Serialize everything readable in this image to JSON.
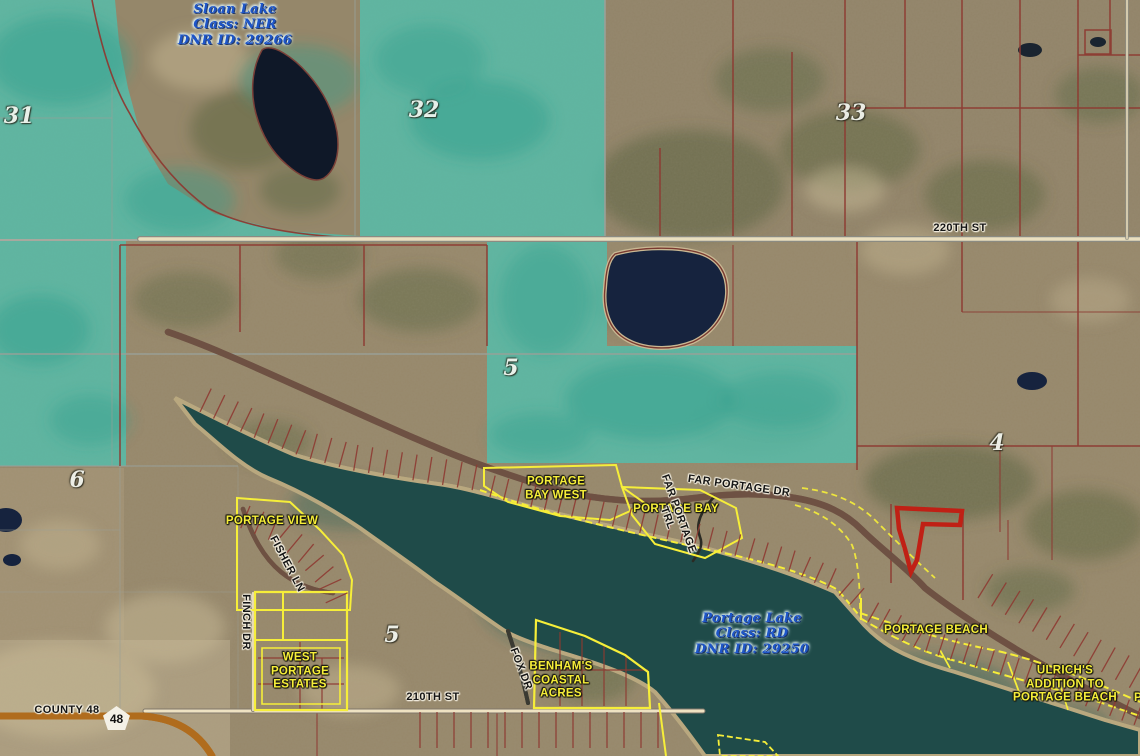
{
  "map": {
    "colors": {
      "teal_overlay": "#52bfae",
      "water_dark": "#1c2b44",
      "lake_green": "#1f4b49",
      "parcel_line": "#8e3a32",
      "selected_parcel": "#c02015",
      "subdivision_yellow": "#f6ee39",
      "road_fill": "#eee2c2",
      "county_road_orange": "#f0a43c",
      "lake_label_blue": "#1d55c9"
    },
    "lake_labels": [
      {
        "lines": [
          "Sloan Lake",
          "Class: NER",
          "DNR ID: 29266"
        ],
        "x": 235,
        "y": 25,
        "rot": 0
      },
      {
        "lines": [
          "Portage Lake",
          "Class: RD",
          "DNR ID: 29250"
        ],
        "x": 752,
        "y": 634,
        "rot": 0
      }
    ],
    "section_numbers": [
      {
        "lines": [
          "31"
        ],
        "x": 19,
        "y": 116,
        "rot": 0
      },
      {
        "lines": [
          "32"
        ],
        "x": 424,
        "y": 110,
        "rot": 0
      },
      {
        "lines": [
          "33"
        ],
        "x": 851,
        "y": 113,
        "rot": 0
      },
      {
        "lines": [
          "5"
        ],
        "x": 511,
        "y": 368,
        "rot": 0
      },
      {
        "lines": [
          "6"
        ],
        "x": 77,
        "y": 480,
        "rot": 0
      },
      {
        "lines": [
          "4"
        ],
        "x": 997,
        "y": 443,
        "rot": 0
      },
      {
        "lines": [
          "5"
        ],
        "x": 392,
        "y": 635,
        "rot": 0
      }
    ],
    "road_labels": [
      {
        "lines": [
          "220TH ST"
        ],
        "x": 960,
        "y": 228,
        "rot": 0
      },
      {
        "lines": [
          "FAR PORTAGE DR"
        ],
        "x": 739,
        "y": 486,
        "rot": 8
      },
      {
        "lines": [
          "FAR PORTAGE",
          "TRL"
        ],
        "x": 673,
        "y": 516,
        "rot": 70
      },
      {
        "lines": [
          "FISHER LN"
        ],
        "x": 287,
        "y": 564,
        "rot": 62
      },
      {
        "lines": [
          "FINCH DR"
        ],
        "x": 246,
        "y": 622,
        "rot": 90
      },
      {
        "lines": [
          "FOX DR"
        ],
        "x": 521,
        "y": 669,
        "rot": 69
      },
      {
        "lines": [
          "210TH ST"
        ],
        "x": 433,
        "y": 697,
        "rot": 0
      },
      {
        "lines": [
          "COUNTY 48"
        ],
        "x": 67,
        "y": 710,
        "rot": 0
      }
    ],
    "subdivision_labels": [
      {
        "lines": [
          "PORTAGE",
          "BAY WEST"
        ],
        "x": 556,
        "y": 489,
        "rot": 0
      },
      {
        "lines": [
          "PORTAGE BAY"
        ],
        "x": 676,
        "y": 510,
        "rot": 0
      },
      {
        "lines": [
          "PORTAGE VIEW"
        ],
        "x": 272,
        "y": 522,
        "rot": 0
      },
      {
        "lines": [
          "WEST",
          "PORTAGE",
          "ESTATES"
        ],
        "x": 300,
        "y": 672,
        "rot": 0
      },
      {
        "lines": [
          "BENHAM'S",
          "COASTAL",
          "ACRES"
        ],
        "x": 561,
        "y": 681,
        "rot": 0
      },
      {
        "lines": [
          "PORTAGE BEACH"
        ],
        "x": 936,
        "y": 631,
        "rot": 0
      },
      {
        "lines": [
          "ULRICH'S",
          "ADDITION TO",
          "PORTAGE BEACH"
        ],
        "x": 1065,
        "y": 685,
        "rot": 0
      },
      {
        "lines": [
          "PORTAGE"
        ],
        "x": 1163,
        "y": 699,
        "rot": 0
      }
    ],
    "shield": {
      "route": "48"
    }
  }
}
